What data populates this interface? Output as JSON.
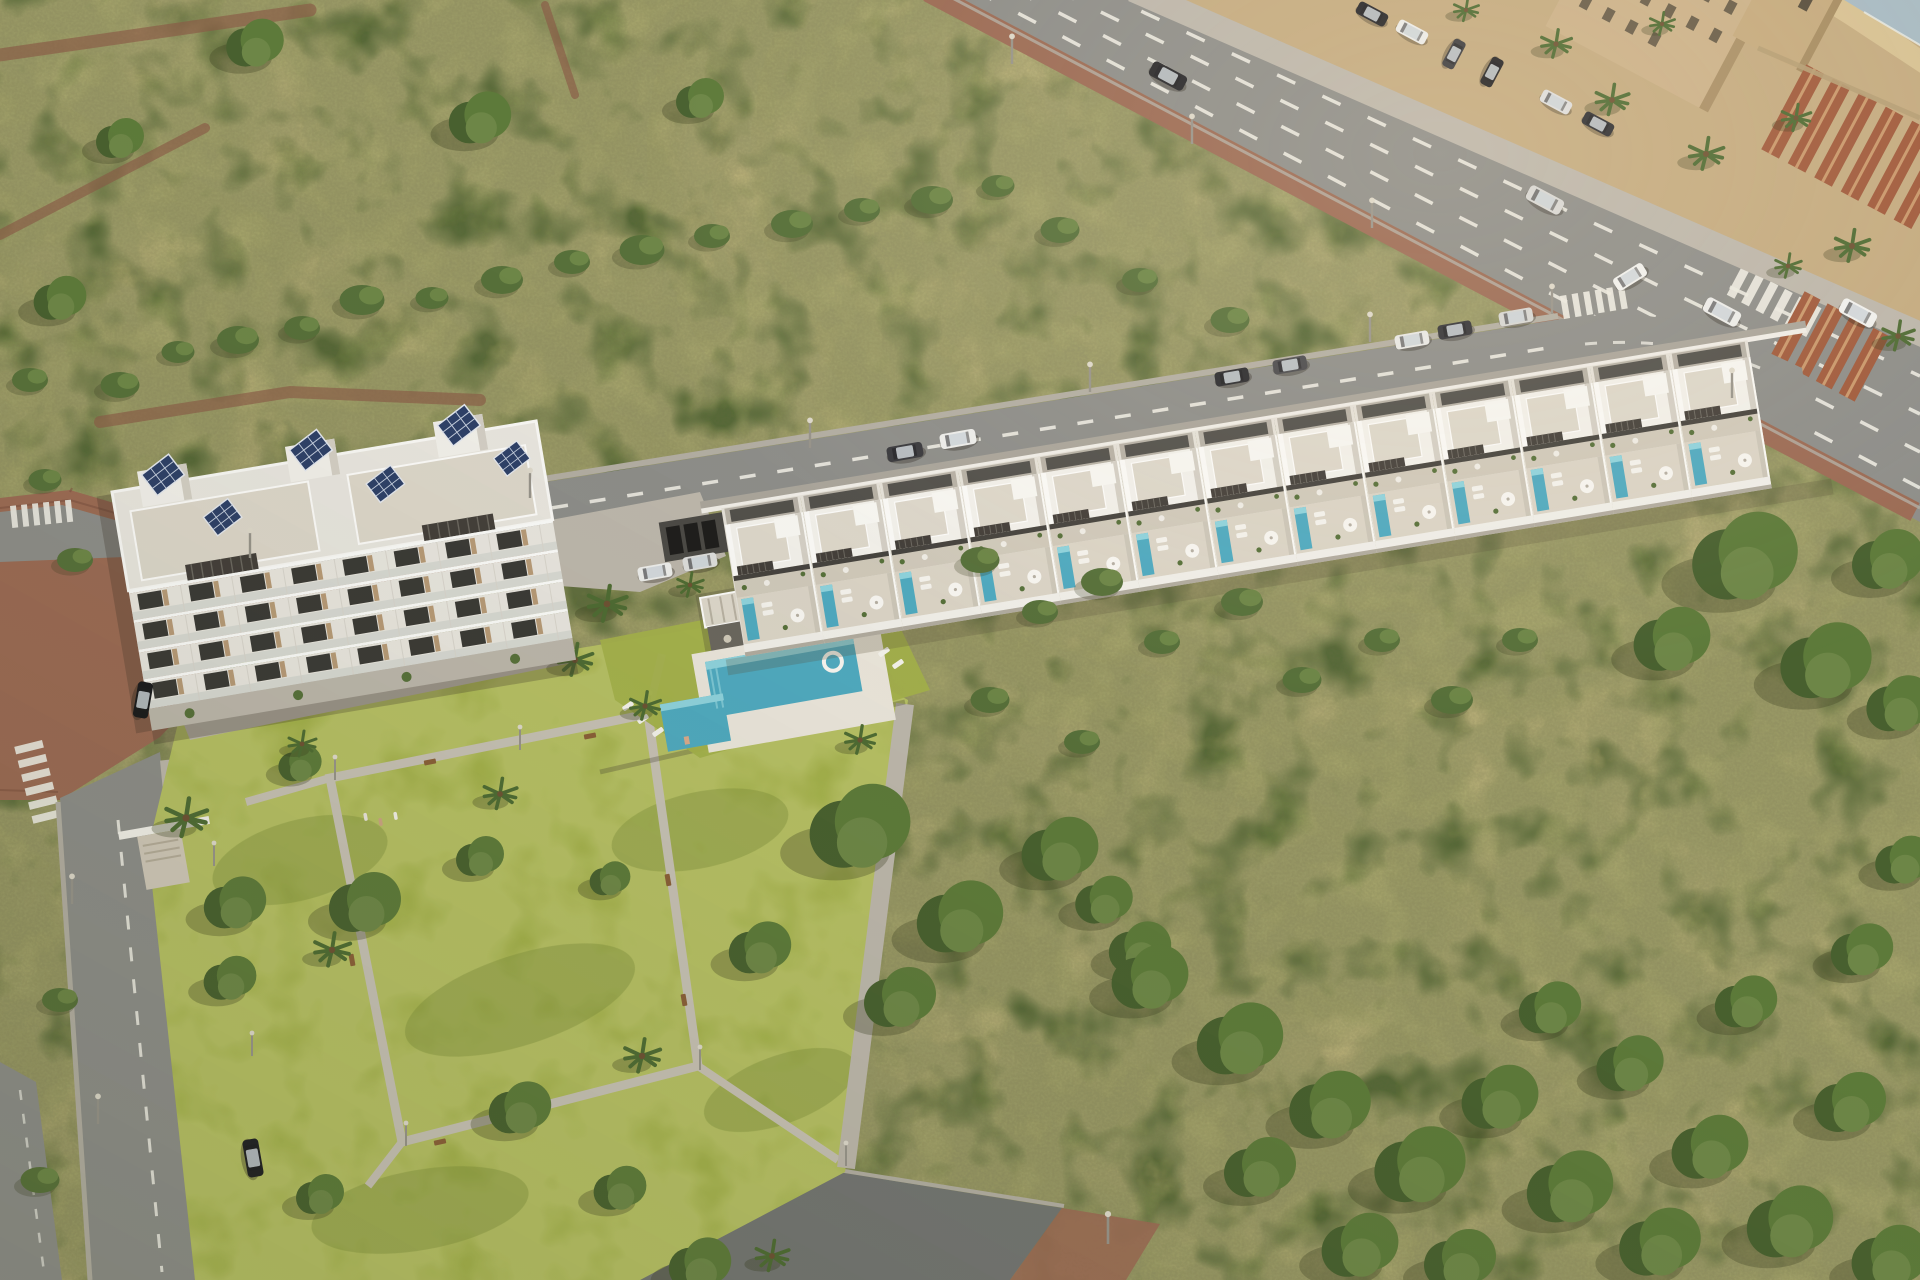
{
  "scene": {
    "description": "Aerial architectural render of a new-build coastal residential development: a four-storey apartment block with rooftop solar panels, a long row of terraced townhouses with private plunge pools along a road, a communal pool with pavilion, a landscaped public park, wide avenue with traffic, surrounding dry scrubland, and an existing terracotta-roofed neighbourhood with a glimpse of the sea in the top-right corner",
    "view": "oblique aerial",
    "townhouse_count": 13,
    "apartment_floors": 4,
    "apartment_window_bays": 8,
    "solar_array_count": 6,
    "communal_pool": true,
    "private_pools_per_townhouse": 1,
    "features": [
      "solar panels",
      "roof terraces",
      "pergolas",
      "communal pool",
      "pool pavilion",
      "sun loungers",
      "parasols",
      "public park with paths and benches",
      "palm trees",
      "zebra crossings",
      "street lamps",
      "parked and moving cars",
      "dirt trails in scrubland",
      "sea glimpse"
    ]
  },
  "colors": {
    "scrub_base": "#b4a971",
    "scrub_green": "#697c40",
    "scrub_dark": "#4c6030",
    "dry_highlight": "#d6c690",
    "road_asphalt": "#8d8d89",
    "road_dark_asphalt": "#737572",
    "lane_marking": "#ebe9e1",
    "sidewalk_brick": "#9b6a54",
    "sidewalk_gray": "#bcb6ab",
    "curb_light": "#b2ada2",
    "building_white": "#f1efe9",
    "building_offwhite": "#e8e5de",
    "building_shade": "#d3cec4",
    "roof_terrace": "#dcd6c9",
    "terrace_paving": "#cfc8b9",
    "pergola_dark": "#443f3a",
    "glass_dark": "#3b3a36",
    "wood_accent": "#b79a77",
    "solar_panel": "#2e4068",
    "solar_grid": "#c5cede",
    "pool_water": "#4fa9bf",
    "pool_water_light": "#8ed2dc",
    "lawn_green": "#a3b04b",
    "lawn_shade": "#7d8f3a",
    "tree_green": "#5d7a3a",
    "tree_green_light": "#6d8647",
    "tree_dark": "#48602f",
    "bush_green": "#57703a",
    "terracotta_roof": "#a05a3c",
    "terracotta_ridge": "#c9976b",
    "tan_building": "#cbb189",
    "tan_ground": "#c4ab80",
    "sea_water": "#a7bac3",
    "sand_beach": "#d7c193",
    "bench_wood": "#8a5f38",
    "car_dark": "#26262a",
    "car_white": "#ececea",
    "car_silver": "#d8d8d6"
  }
}
